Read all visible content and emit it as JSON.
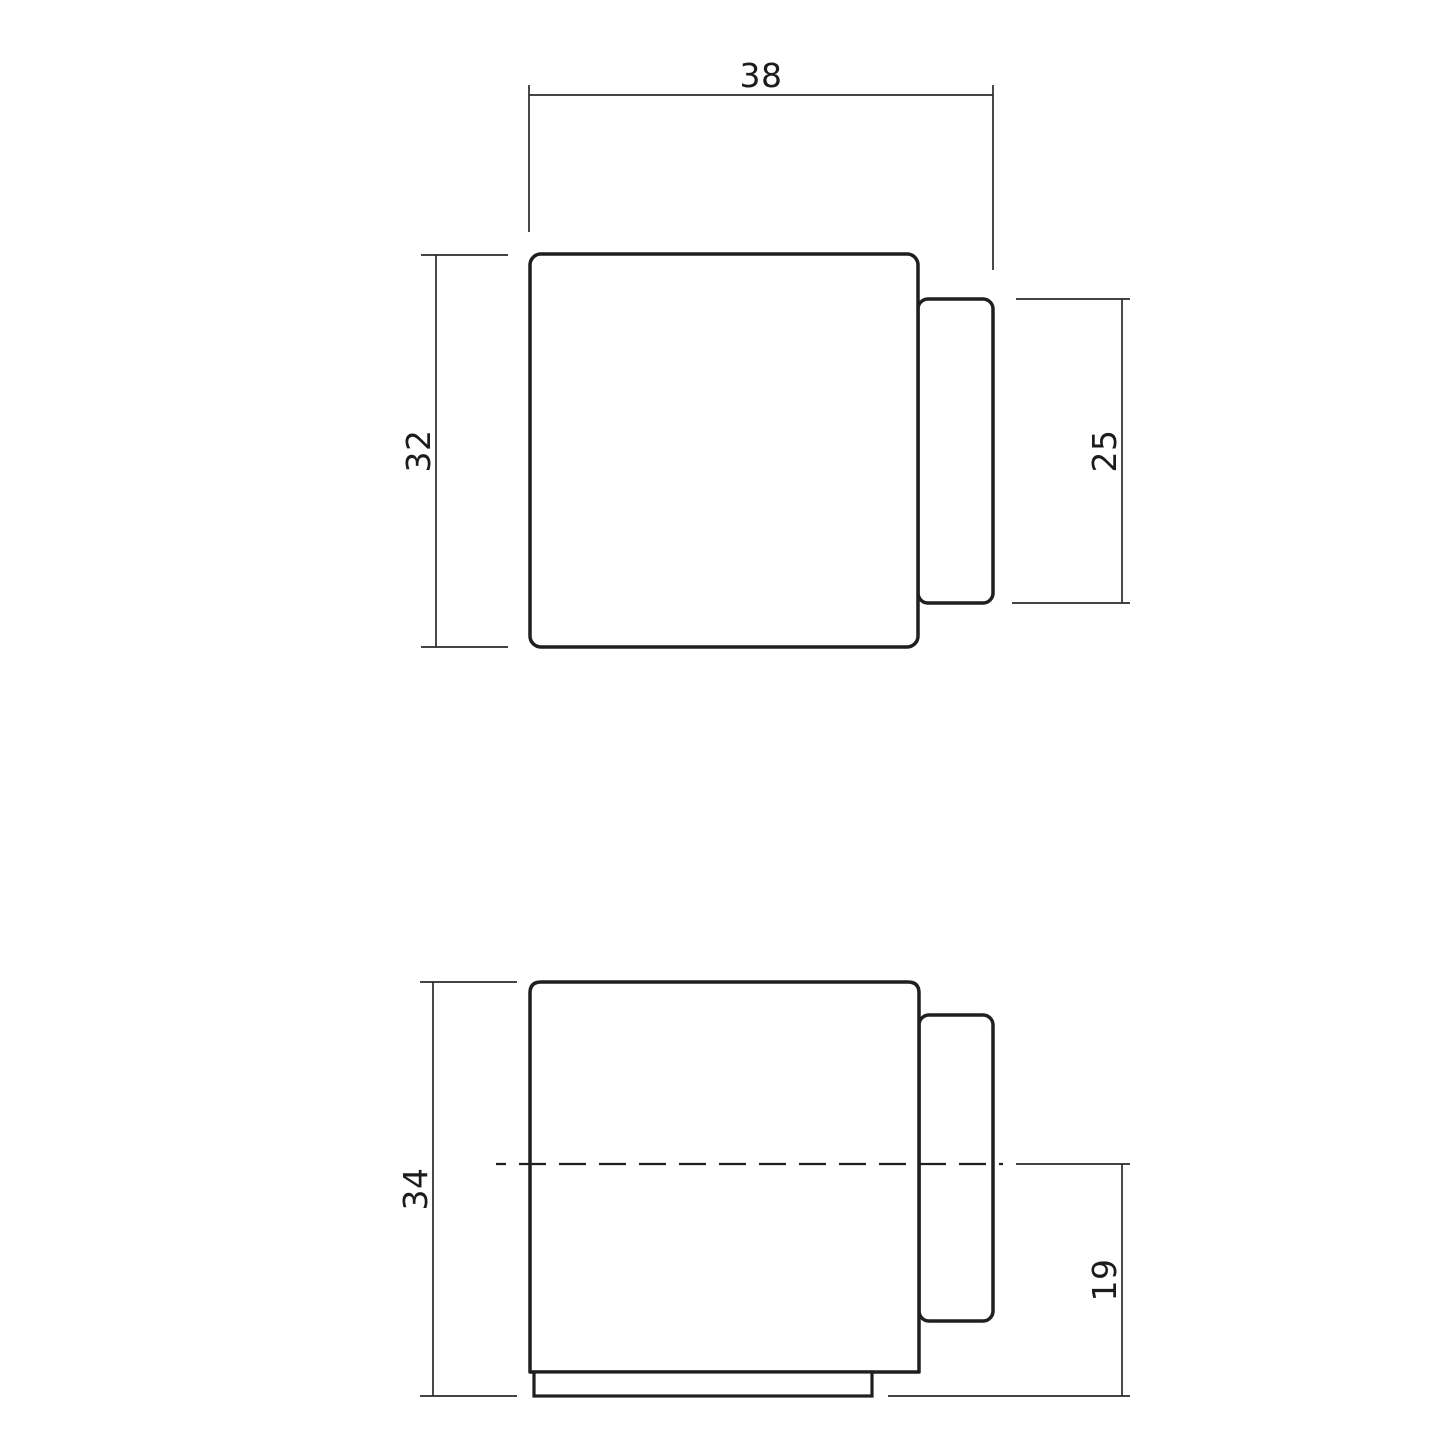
{
  "drawing": {
    "background_color": "#ffffff",
    "outline_color": "#1f1f1f",
    "dimension_line_color": "#2a2a2a",
    "text_color": "#1c1c1c",
    "views": {
      "top": {
        "dims": {
          "overall_width": "38",
          "body_height": "32",
          "bumper_height": "25"
        }
      },
      "front": {
        "dims": {
          "overall_height": "34",
          "bumper_bottom_offset": "19"
        }
      }
    }
  }
}
